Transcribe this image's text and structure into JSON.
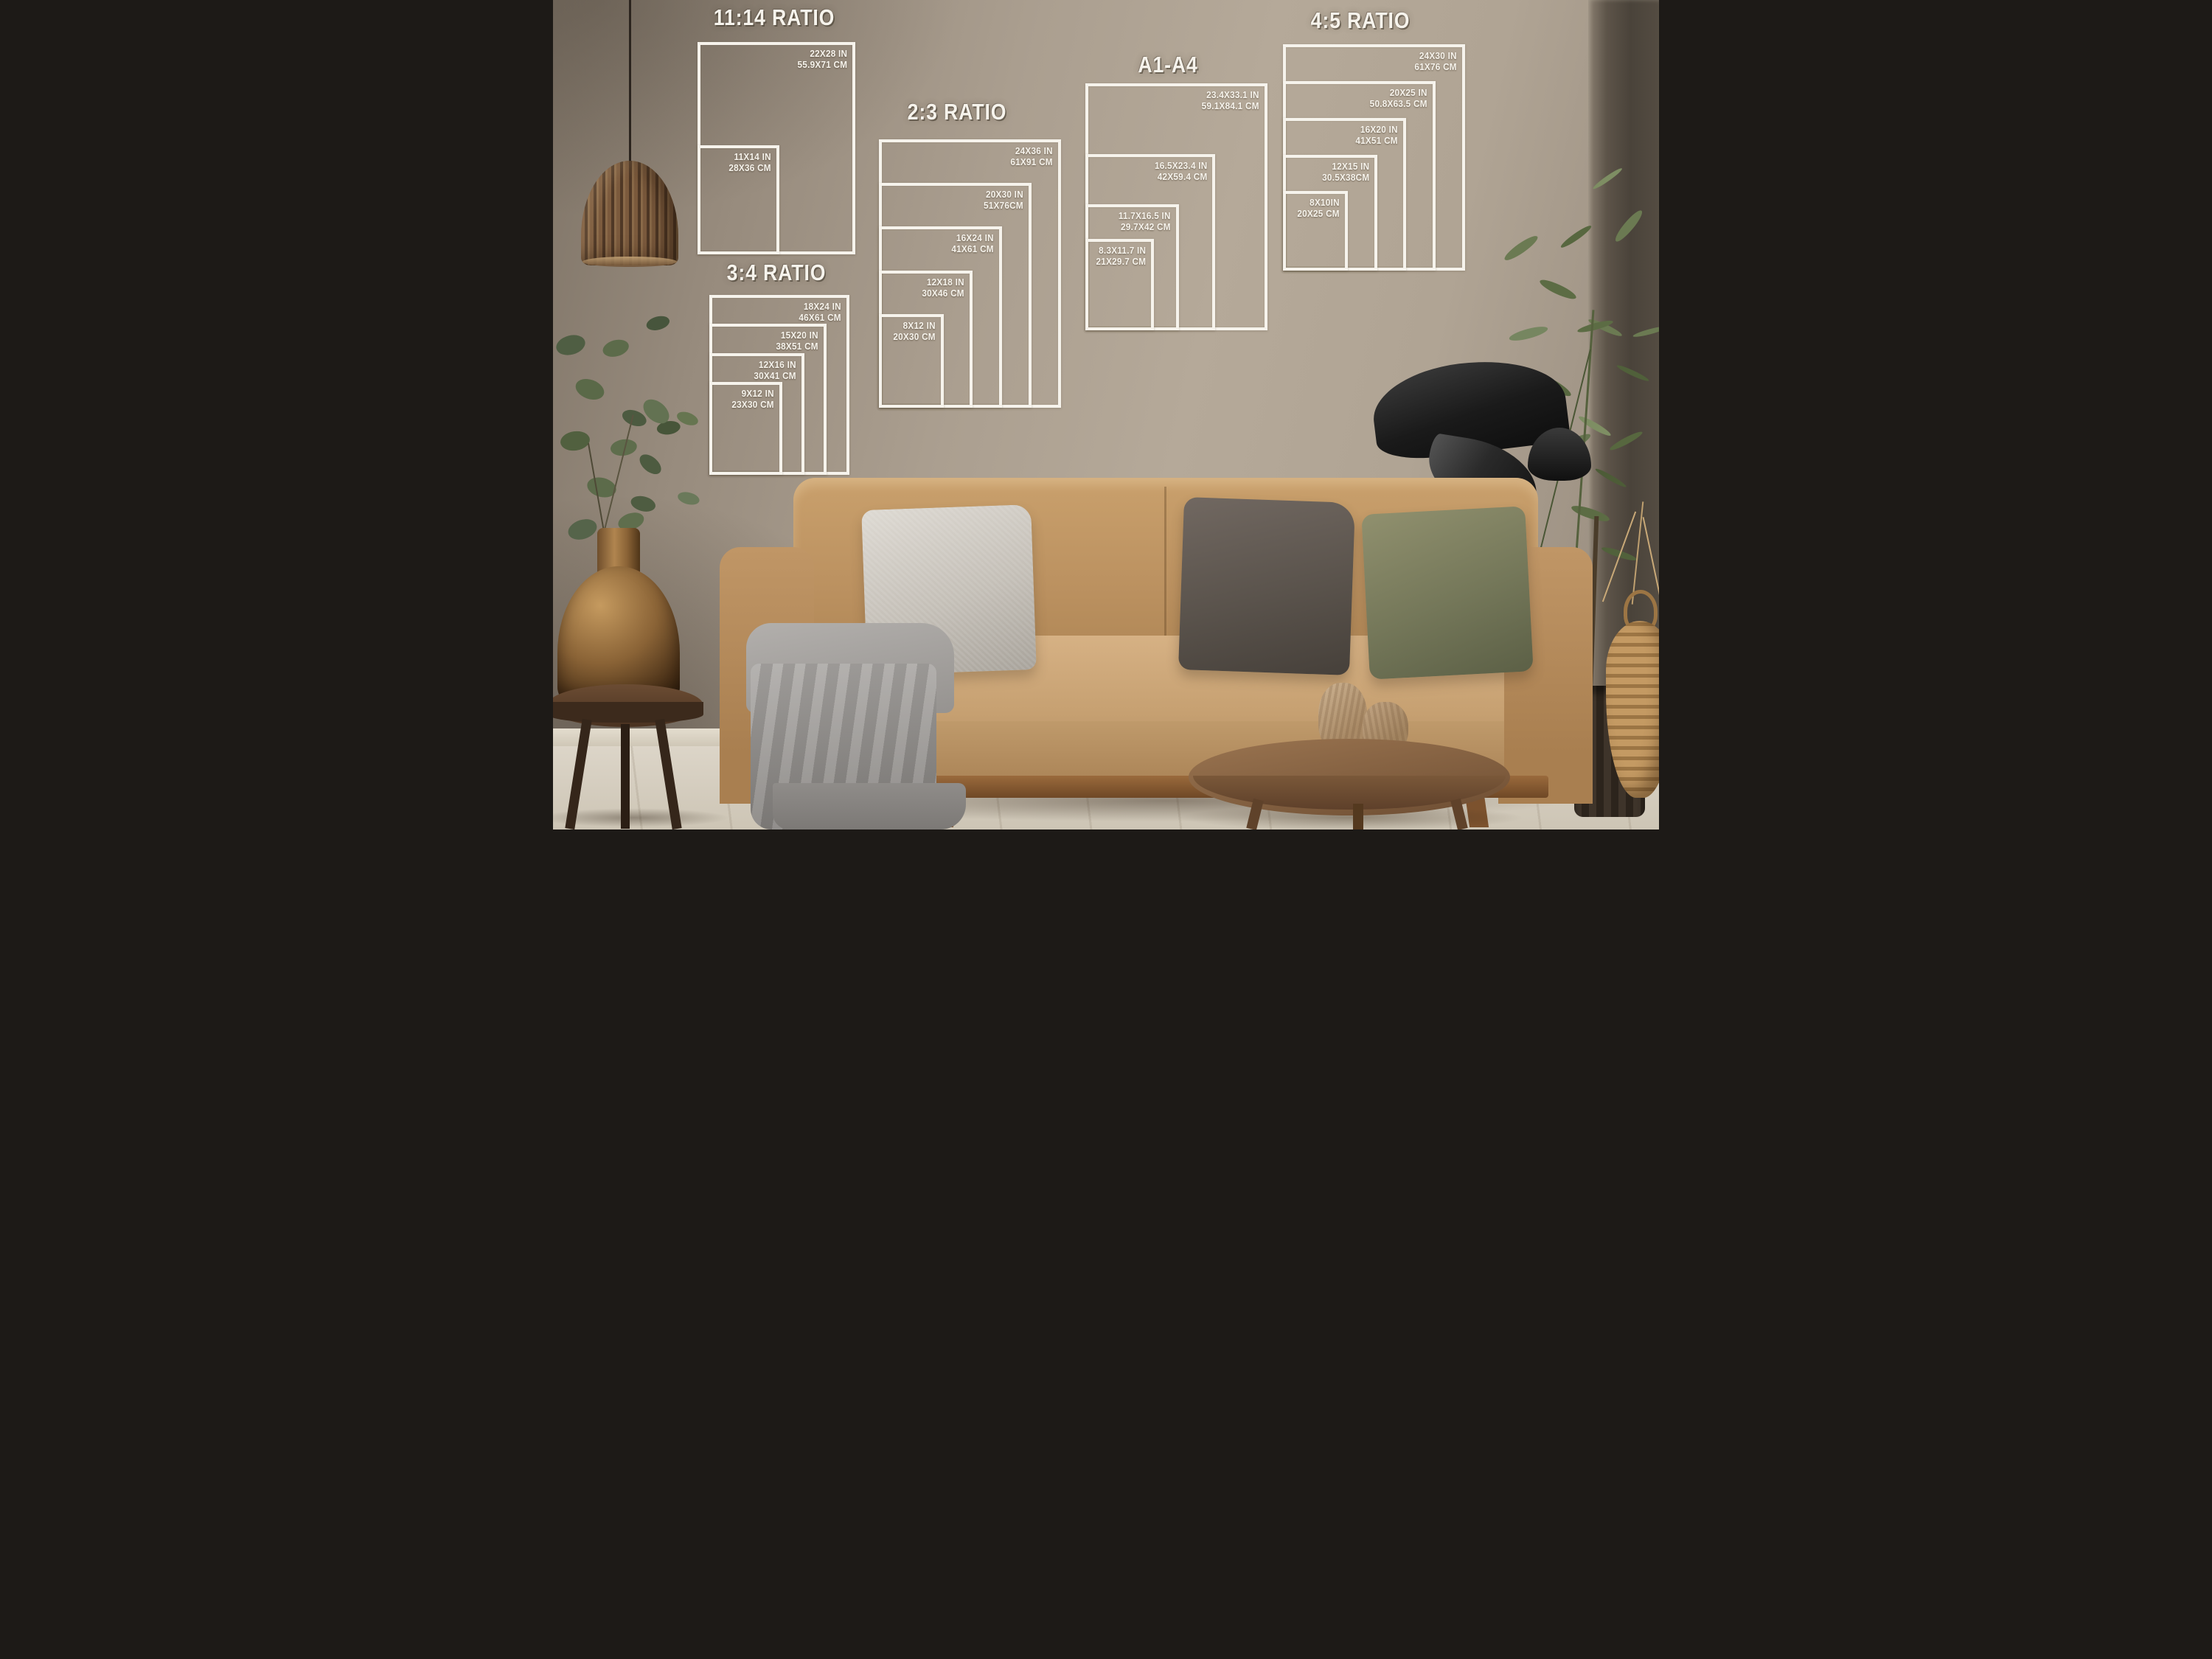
{
  "groups": [
    {
      "id": "11-14",
      "title": "11:14 RATIO",
      "sizes": [
        {
          "in": "22X28 IN",
          "cm": "55.9X71 CM"
        },
        {
          "in": "11X14 IN",
          "cm": "28X36 CM"
        }
      ]
    },
    {
      "id": "3-4",
      "title": "3:4 RATIO",
      "sizes": [
        {
          "in": "18X24 IN",
          "cm": "46X61 CM"
        },
        {
          "in": "15X20 IN",
          "cm": "38X51 CM"
        },
        {
          "in": "12X16 IN",
          "cm": "30X41 CM"
        },
        {
          "in": "9X12 IN",
          "cm": "23X30 CM"
        }
      ]
    },
    {
      "id": "2-3",
      "title": "2:3 RATIO",
      "sizes": [
        {
          "in": "24X36 IN",
          "cm": "61X91 CM"
        },
        {
          "in": "20X30 IN",
          "cm": "51X76CM"
        },
        {
          "in": "16X24 IN",
          "cm": "41X61 CM"
        },
        {
          "in": "12X18 IN",
          "cm": "30X46 CM"
        },
        {
          "in": "8X12 IN",
          "cm": "20X30 CM"
        }
      ]
    },
    {
      "id": "a1-a4",
      "title": "A1-A4",
      "sizes": [
        {
          "in": "23.4X33.1 IN",
          "cm": "59.1X84.1 CM"
        },
        {
          "in": "16.5X23.4 IN",
          "cm": "42X59.4 CM"
        },
        {
          "in": "11.7X16.5 IN",
          "cm": "29.7X42 CM"
        },
        {
          "in": "8.3X11.7 IN",
          "cm": "21X29.7 CM"
        }
      ]
    },
    {
      "id": "4-5",
      "title": "4:5 RATIO",
      "sizes": [
        {
          "in": "24X30 IN",
          "cm": "61X76 CM"
        },
        {
          "in": "20X25 IN",
          "cm": "50.8X63.5 CM"
        },
        {
          "in": "16X20 IN",
          "cm": "41X51 CM"
        },
        {
          "in": "12X15 IN",
          "cm": "30.5X38CM"
        },
        {
          "in": "8X10IN",
          "cm": "20X25 CM"
        }
      ]
    }
  ],
  "palette": {
    "frame_white": "#f6f3ec",
    "wall": "#aba08f",
    "wall_shadow": "#6f665a",
    "floor": "#d8d1c4",
    "sofa": "#c49b69",
    "seat": "#d2ad7d",
    "pillow_silver": "#ccc7c0",
    "pillow_dark": "#5c544e",
    "pillow_olive": "#767a5b",
    "blanket": "#9b9895",
    "wood_table": "#8b6647",
    "copper_vase": "#8a6336",
    "lamp_black": "#1c1c1c",
    "plant_green": "#5c6c44",
    "wicker": "#b98d58"
  }
}
